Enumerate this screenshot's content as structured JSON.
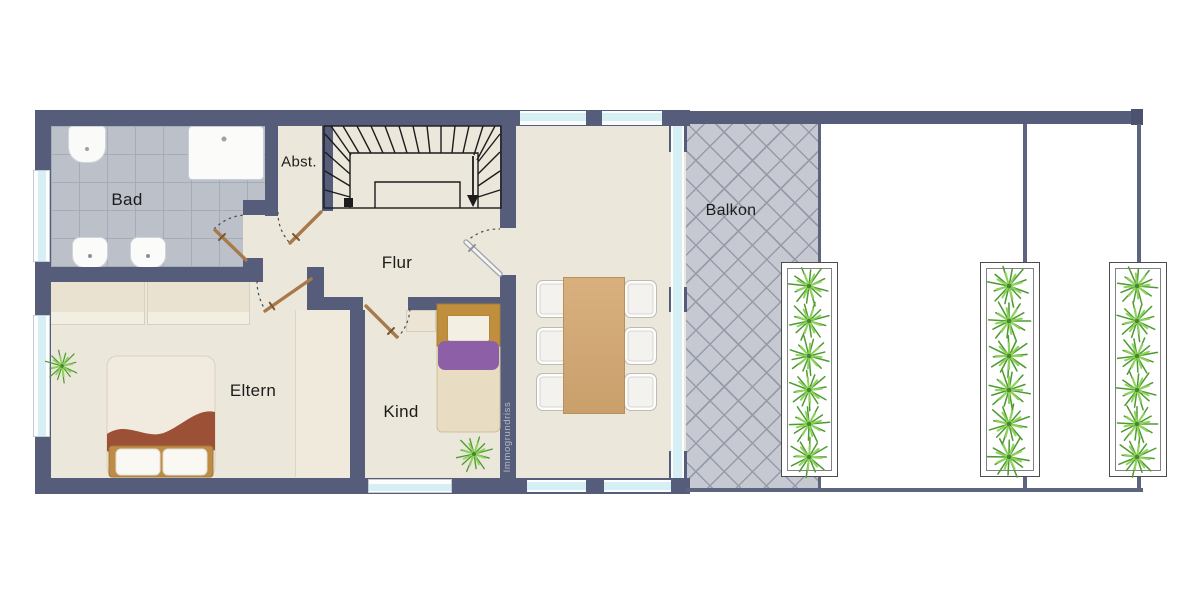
{
  "plan": {
    "rooms": [
      {
        "id": "bad",
        "label": "Bad",
        "floor": "tiled"
      },
      {
        "id": "abstellraum",
        "label": "Abst.",
        "floor": "screed"
      },
      {
        "id": "flur",
        "label": "Flur",
        "floor": "screed"
      },
      {
        "id": "eltern",
        "label": "Eltern",
        "floor": "screed"
      },
      {
        "id": "kind",
        "label": "Kind",
        "floor": "screed"
      },
      {
        "id": "balkon",
        "label": "Balkon",
        "floor": "diagonal-tiles"
      }
    ],
    "watermark": "Immogrundriss",
    "furniture": {
      "bathroom": [
        "toilet",
        "shower",
        "sink",
        "sink"
      ],
      "eltern": [
        "double-bed",
        "wardrobe",
        "wardrobe",
        "plant"
      ],
      "kind": [
        "single-bed",
        "nightstand",
        "plant"
      ],
      "dining": {
        "table": 1,
        "chairs": 6
      },
      "terrace": {
        "planters": 3,
        "plants_per_planter": 6
      },
      "staircase": {
        "type": "u-shaped-winder",
        "direction_arrow": "down"
      }
    },
    "colors": {
      "wall": "#555d7a",
      "floor": "#ece7db",
      "bath_tile": "#bcc0c9",
      "balcony_tile": "#c6c9d1",
      "glass": "#d6eff5",
      "table_wood": "#d2a873",
      "blanket_eltern": "#9c5137",
      "blanket_kind": "#8c5fa7",
      "plant_green": "#4e9b31",
      "door_leaf": "#a87a4b"
    }
  }
}
